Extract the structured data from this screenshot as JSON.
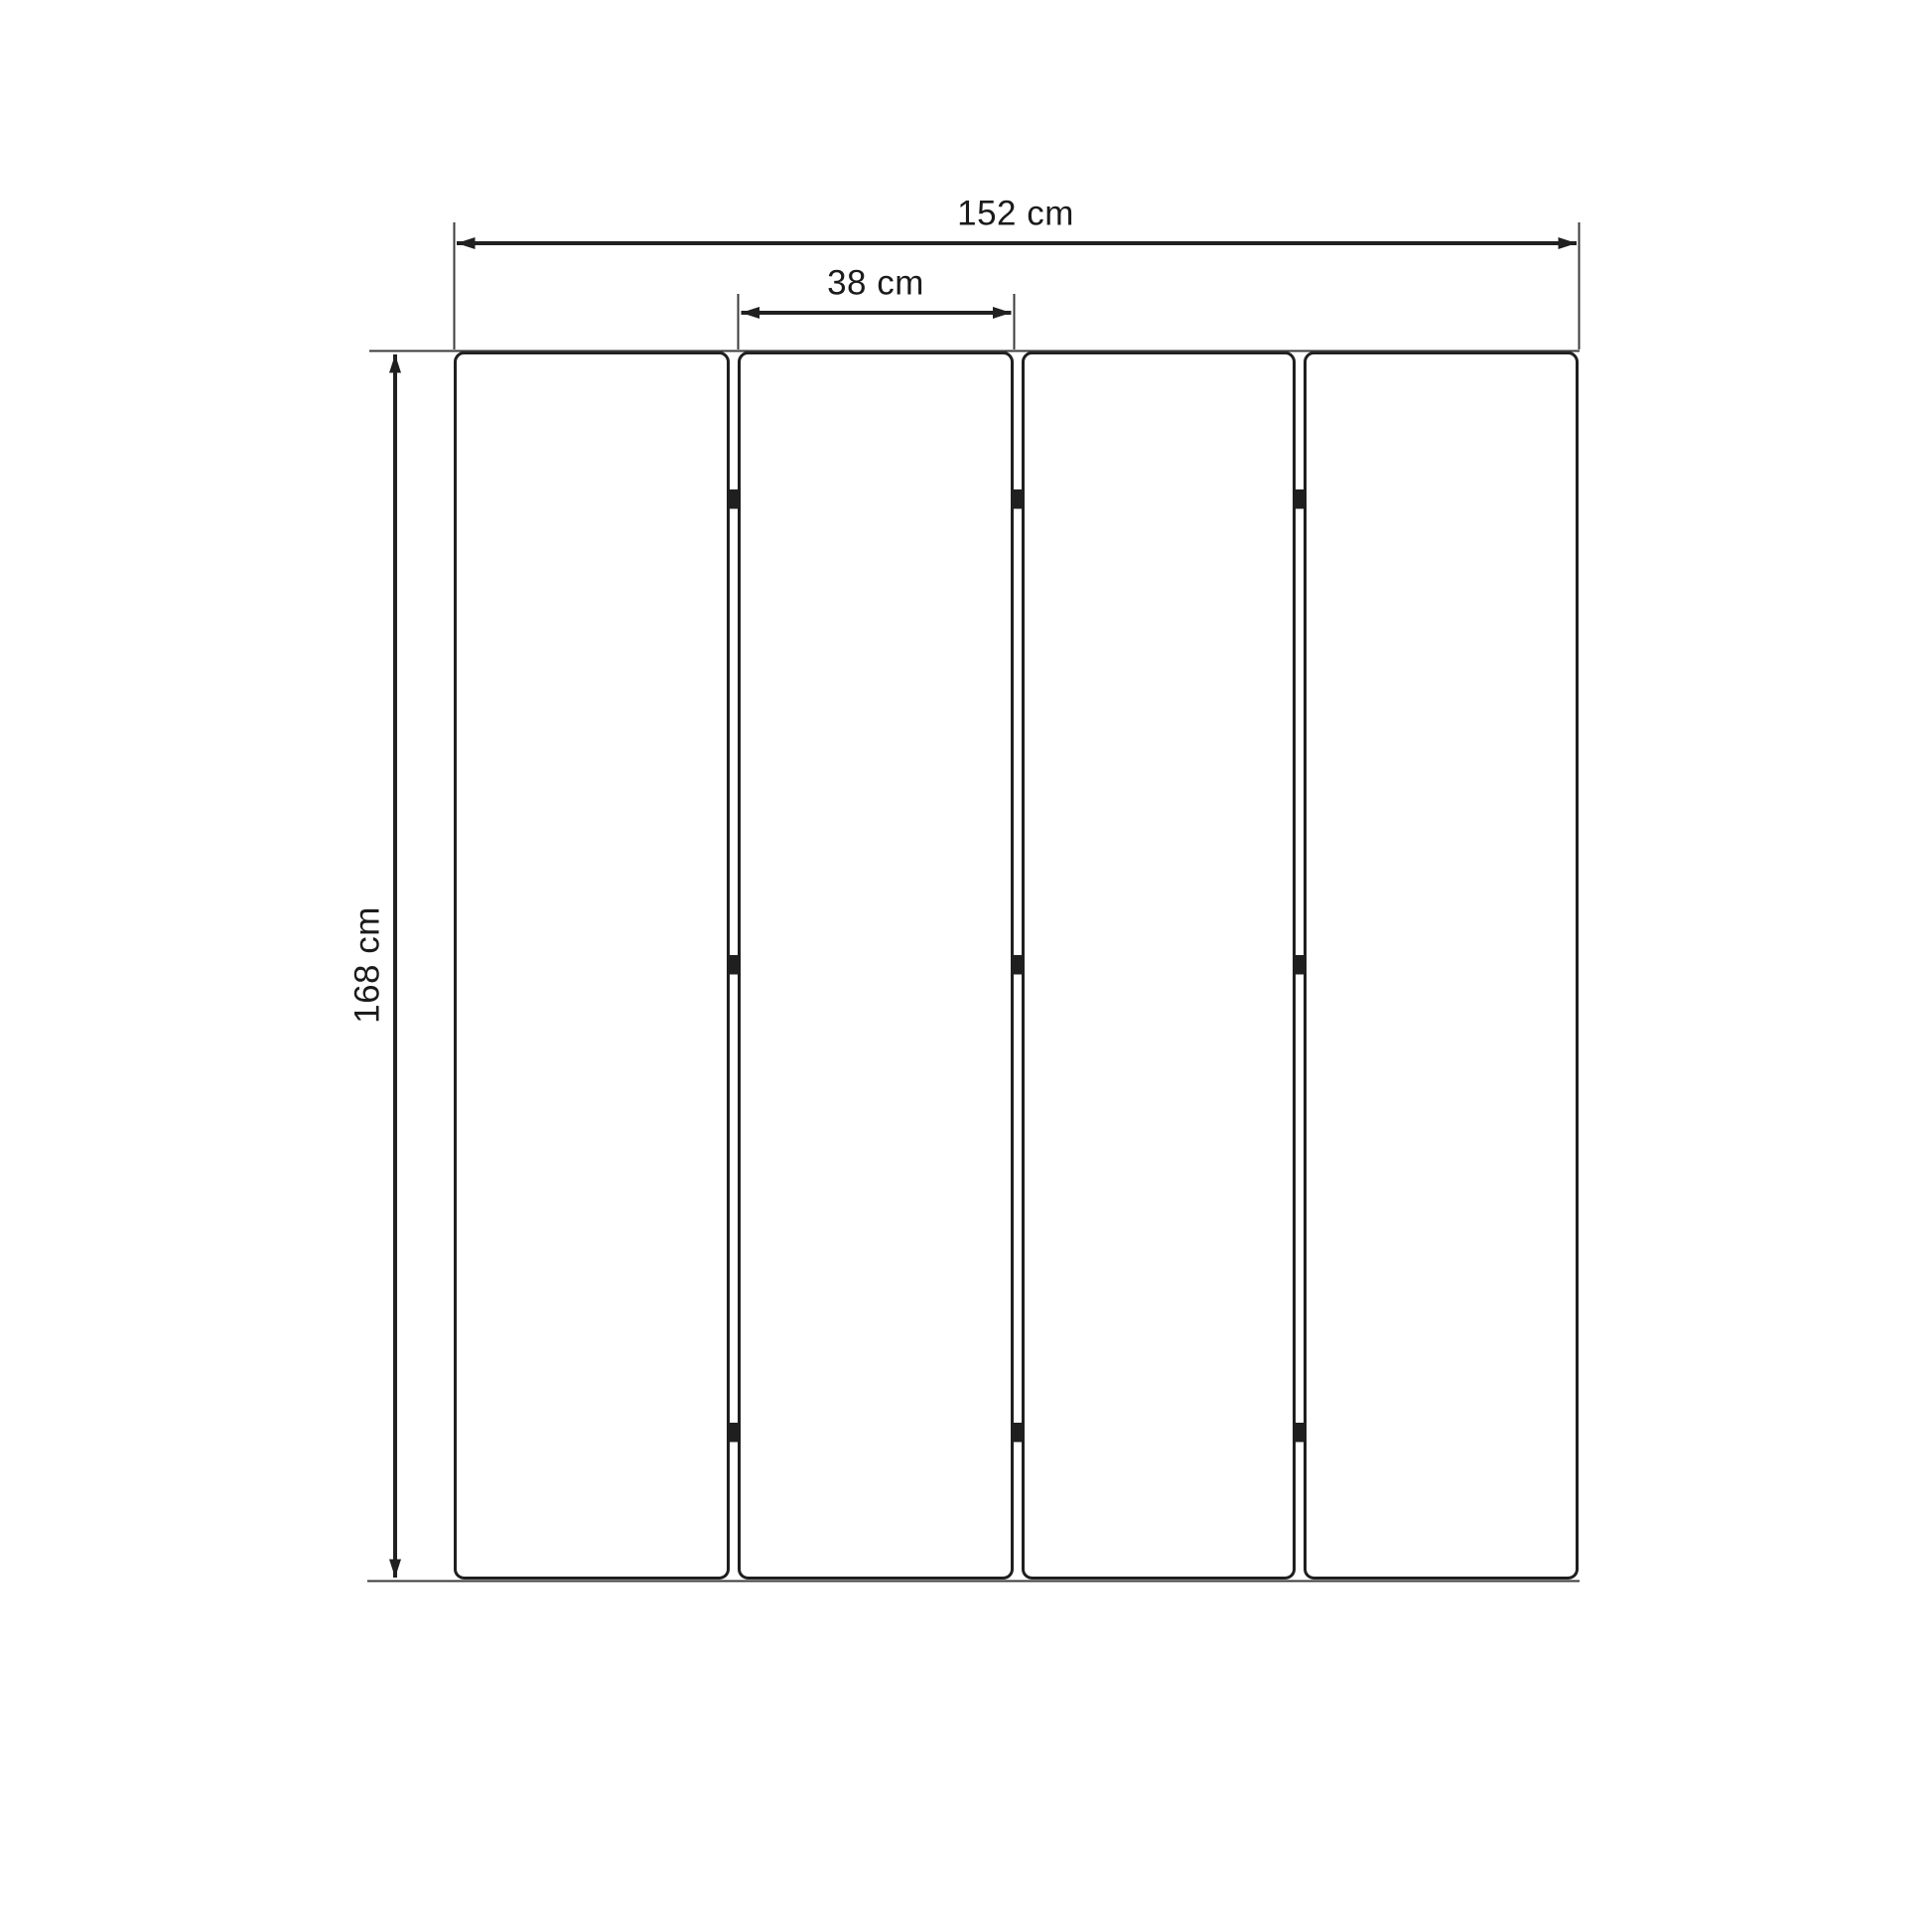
{
  "diagram": {
    "subject": "folding-screen-dimension-drawing",
    "description": "Front-view technical line drawing of a four-panel folding room divider with hinges, annotated with overall width, single panel width and height dimensions",
    "panel_count": 4,
    "hinge_rows_per_gap": 3,
    "dimensions": {
      "total_width": {
        "label": "152 cm",
        "value": 152,
        "unit": "cm"
      },
      "panel_width": {
        "label": "38 cm",
        "value": 38,
        "unit": "cm"
      },
      "height": {
        "label": "168 cm",
        "value": 168,
        "unit": "cm"
      }
    },
    "colors": {
      "background": "#ffffff",
      "outline": "#1f1f1f",
      "dimension_line": "#202020",
      "extension_line": "#3b3b3b",
      "text": "#1b1b1b"
    }
  }
}
